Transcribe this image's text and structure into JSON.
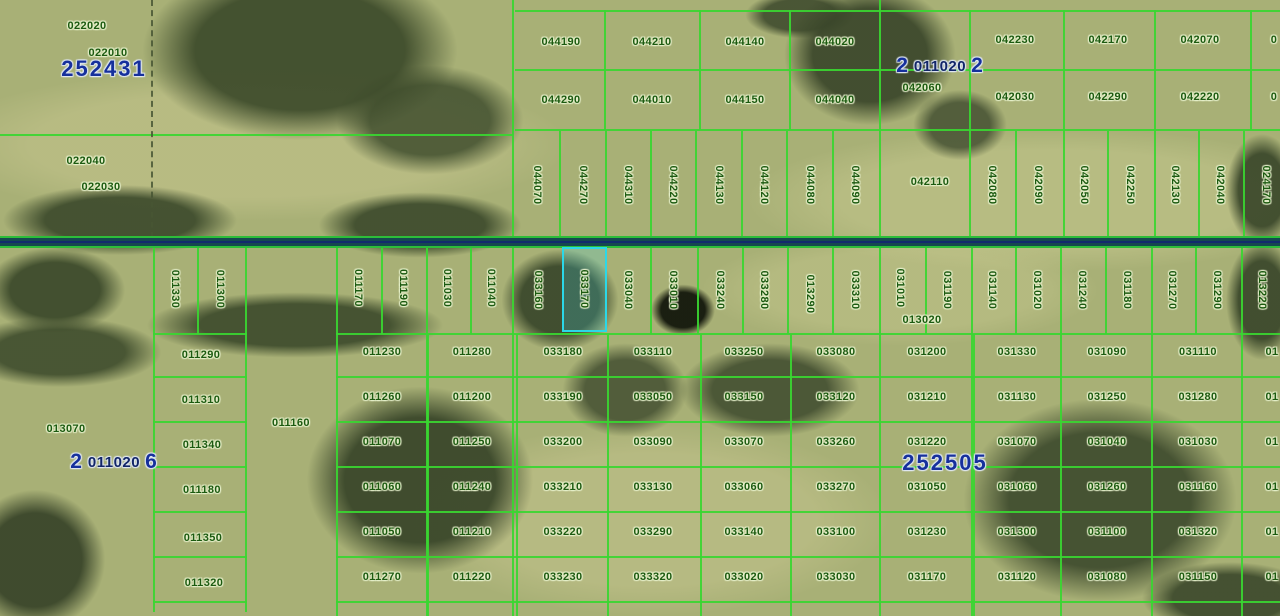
{
  "map": {
    "description": "County parcel map overlay on aerial imagery",
    "colors": {
      "parcel_line": "#39d631",
      "parcel_label": "#1c5a10",
      "section_label": "#16309c",
      "highlight_border": "#2bd8e8",
      "road_fill": "#15484f"
    },
    "selected_parcel": {
      "id": "033170"
    },
    "section_labels": [
      {
        "text": "252431",
        "x": 104,
        "y": 69
      },
      {
        "text": "252505",
        "x": 945,
        "y": 463
      }
    ],
    "section_labels_overlapped": [
      {
        "parts": [
          "2",
          "011020",
          "2"
        ],
        "x": 940,
        "y": 66
      },
      {
        "parts": [
          "2",
          "011020",
          "6"
        ],
        "x": 114,
        "y": 462
      }
    ],
    "parcel_labels_horizontal": [
      {
        "t": "022020",
        "x": 87,
        "y": 26
      },
      {
        "t": "022010",
        "x": 108,
        "y": 53
      },
      {
        "t": "022040",
        "x": 86,
        "y": 161
      },
      {
        "t": "022030",
        "x": 101,
        "y": 187
      },
      {
        "t": "044190",
        "x": 561,
        "y": 42
      },
      {
        "t": "044210",
        "x": 652,
        "y": 42
      },
      {
        "t": "044140",
        "x": 745,
        "y": 42
      },
      {
        "t": "044020",
        "x": 835,
        "y": 42
      },
      {
        "t": "044290",
        "x": 561,
        "y": 100
      },
      {
        "t": "044010",
        "x": 652,
        "y": 100
      },
      {
        "t": "044150",
        "x": 745,
        "y": 100
      },
      {
        "t": "044040",
        "x": 835,
        "y": 100
      },
      {
        "t": "042230",
        "x": 1015,
        "y": 40
      },
      {
        "t": "042170",
        "x": 1108,
        "y": 40
      },
      {
        "t": "042070",
        "x": 1200,
        "y": 40
      },
      {
        "t": "042060",
        "x": 922,
        "y": 88
      },
      {
        "t": "042030",
        "x": 1015,
        "y": 97
      },
      {
        "t": "042290",
        "x": 1108,
        "y": 97
      },
      {
        "t": "042220",
        "x": 1200,
        "y": 97
      },
      {
        "t": "0",
        "x": 1274,
        "y": 40
      },
      {
        "t": "0",
        "x": 1274,
        "y": 97
      },
      {
        "t": "042110",
        "x": 930,
        "y": 182
      },
      {
        "t": "013020",
        "x": 922,
        "y": 320
      },
      {
        "t": "013070",
        "x": 66,
        "y": 429
      },
      {
        "t": "011160",
        "x": 291,
        "y": 423
      },
      {
        "t": "011290",
        "x": 201,
        "y": 355
      },
      {
        "t": "011310",
        "x": 201,
        "y": 400
      },
      {
        "t": "011340",
        "x": 202,
        "y": 445
      },
      {
        "t": "011180",
        "x": 202,
        "y": 490
      },
      {
        "t": "011350",
        "x": 203,
        "y": 538
      },
      {
        "t": "011320",
        "x": 204,
        "y": 583
      },
      {
        "t": "011230",
        "x": 382,
        "y": 352
      },
      {
        "t": "011280",
        "x": 472,
        "y": 352
      },
      {
        "t": "033180",
        "x": 563,
        "y": 352
      },
      {
        "t": "033110",
        "x": 653,
        "y": 352
      },
      {
        "t": "033250",
        "x": 744,
        "y": 352
      },
      {
        "t": "033080",
        "x": 836,
        "y": 352
      },
      {
        "t": "031200",
        "x": 927,
        "y": 352
      },
      {
        "t": "031330",
        "x": 1017,
        "y": 352
      },
      {
        "t": "031090",
        "x": 1107,
        "y": 352
      },
      {
        "t": "031110",
        "x": 1198,
        "y": 352
      },
      {
        "t": "01",
        "x": 1272,
        "y": 352
      },
      {
        "t": "011260",
        "x": 382,
        "y": 397
      },
      {
        "t": "011200",
        "x": 472,
        "y": 397
      },
      {
        "t": "033190",
        "x": 563,
        "y": 397
      },
      {
        "t": "033050",
        "x": 653,
        "y": 397
      },
      {
        "t": "033150",
        "x": 744,
        "y": 397
      },
      {
        "t": "033120",
        "x": 836,
        "y": 397
      },
      {
        "t": "031210",
        "x": 927,
        "y": 397
      },
      {
        "t": "031130",
        "x": 1017,
        "y": 397
      },
      {
        "t": "031250",
        "x": 1107,
        "y": 397
      },
      {
        "t": "031280",
        "x": 1198,
        "y": 397
      },
      {
        "t": "01",
        "x": 1272,
        "y": 397
      },
      {
        "t": "011070",
        "x": 382,
        "y": 442
      },
      {
        "t": "011250",
        "x": 472,
        "y": 442
      },
      {
        "t": "033200",
        "x": 563,
        "y": 442
      },
      {
        "t": "033090",
        "x": 653,
        "y": 442
      },
      {
        "t": "033070",
        "x": 744,
        "y": 442
      },
      {
        "t": "033260",
        "x": 836,
        "y": 442
      },
      {
        "t": "031220",
        "x": 927,
        "y": 442
      },
      {
        "t": "031070",
        "x": 1017,
        "y": 442
      },
      {
        "t": "031040",
        "x": 1107,
        "y": 442
      },
      {
        "t": "031030",
        "x": 1198,
        "y": 442
      },
      {
        "t": "01",
        "x": 1272,
        "y": 442
      },
      {
        "t": "011060",
        "x": 382,
        "y": 487
      },
      {
        "t": "011240",
        "x": 472,
        "y": 487
      },
      {
        "t": "033210",
        "x": 563,
        "y": 487
      },
      {
        "t": "033130",
        "x": 653,
        "y": 487
      },
      {
        "t": "033060",
        "x": 744,
        "y": 487
      },
      {
        "t": "033270",
        "x": 836,
        "y": 487
      },
      {
        "t": "031050",
        "x": 927,
        "y": 487
      },
      {
        "t": "031060",
        "x": 1017,
        "y": 487
      },
      {
        "t": "031260",
        "x": 1107,
        "y": 487
      },
      {
        "t": "031160",
        "x": 1198,
        "y": 487
      },
      {
        "t": "01",
        "x": 1272,
        "y": 487
      },
      {
        "t": "011050",
        "x": 382,
        "y": 532
      },
      {
        "t": "011210",
        "x": 472,
        "y": 532
      },
      {
        "t": "033220",
        "x": 563,
        "y": 532
      },
      {
        "t": "033290",
        "x": 653,
        "y": 532
      },
      {
        "t": "033140",
        "x": 744,
        "y": 532
      },
      {
        "t": "033100",
        "x": 836,
        "y": 532
      },
      {
        "t": "031230",
        "x": 927,
        "y": 532
      },
      {
        "t": "031300",
        "x": 1017,
        "y": 532
      },
      {
        "t": "031100",
        "x": 1107,
        "y": 532
      },
      {
        "t": "031320",
        "x": 1198,
        "y": 532
      },
      {
        "t": "01",
        "x": 1272,
        "y": 532
      },
      {
        "t": "011270",
        "x": 382,
        "y": 577
      },
      {
        "t": "011220",
        "x": 472,
        "y": 577
      },
      {
        "t": "033230",
        "x": 563,
        "y": 577
      },
      {
        "t": "033320",
        "x": 653,
        "y": 577
      },
      {
        "t": "033020",
        "x": 744,
        "y": 577
      },
      {
        "t": "033030",
        "x": 836,
        "y": 577
      },
      {
        "t": "031170",
        "x": 927,
        "y": 577
      },
      {
        "t": "031120",
        "x": 1017,
        "y": 577
      },
      {
        "t": "031080",
        "x": 1107,
        "y": 577
      },
      {
        "t": "031150",
        "x": 1198,
        "y": 577
      },
      {
        "t": "01",
        "x": 1272,
        "y": 577
      }
    ],
    "parcel_labels_vertical": [
      {
        "t": "044070",
        "x": 537,
        "y": 185
      },
      {
        "t": "044270",
        "x": 583,
        "y": 185
      },
      {
        "t": "044310",
        "x": 628,
        "y": 185
      },
      {
        "t": "044220",
        "x": 673,
        "y": 185
      },
      {
        "t": "044130",
        "x": 719,
        "y": 185
      },
      {
        "t": "044120",
        "x": 764,
        "y": 185
      },
      {
        "t": "044080",
        "x": 810,
        "y": 185
      },
      {
        "t": "044090",
        "x": 855,
        "y": 185
      },
      {
        "t": "042080",
        "x": 992,
        "y": 185
      },
      {
        "t": "042090",
        "x": 1038,
        "y": 185
      },
      {
        "t": "042050",
        "x": 1084,
        "y": 185
      },
      {
        "t": "042250",
        "x": 1130,
        "y": 185
      },
      {
        "t": "042130",
        "x": 1175,
        "y": 185
      },
      {
        "t": "042040",
        "x": 1220,
        "y": 185
      },
      {
        "t": "024170",
        "x": 1266,
        "y": 185
      },
      {
        "t": "011330",
        "x": 175,
        "y": 289
      },
      {
        "t": "011300",
        "x": 220,
        "y": 289
      },
      {
        "t": "011170",
        "x": 358,
        "y": 288
      },
      {
        "t": "011190",
        "x": 403,
        "y": 288
      },
      {
        "t": "011030",
        "x": 447,
        "y": 288
      },
      {
        "t": "011040",
        "x": 491,
        "y": 288
      },
      {
        "t": "033160",
        "x": 538,
        "y": 290
      },
      {
        "t": "033170",
        "x": 584,
        "y": 289
      },
      {
        "t": "033040",
        "x": 628,
        "y": 290
      },
      {
        "t": "033010",
        "x": 673,
        "y": 290
      },
      {
        "t": "033240",
        "x": 720,
        "y": 290
      },
      {
        "t": "033280",
        "x": 764,
        "y": 290
      },
      {
        "t": "013290",
        "x": 810,
        "y": 294
      },
      {
        "t": "033310",
        "x": 855,
        "y": 290
      },
      {
        "t": "031010",
        "x": 900,
        "y": 288
      },
      {
        "t": "031190",
        "x": 947,
        "y": 290
      },
      {
        "t": "031140",
        "x": 992,
        "y": 290
      },
      {
        "t": "031020",
        "x": 1037,
        "y": 290
      },
      {
        "t": "031240",
        "x": 1082,
        "y": 290
      },
      {
        "t": "031180",
        "x": 1127,
        "y": 290
      },
      {
        "t": "031270",
        "x": 1172,
        "y": 290
      },
      {
        "t": "031290",
        "x": 1217,
        "y": 290
      },
      {
        "t": "013220",
        "x": 1262,
        "y": 290
      }
    ]
  }
}
